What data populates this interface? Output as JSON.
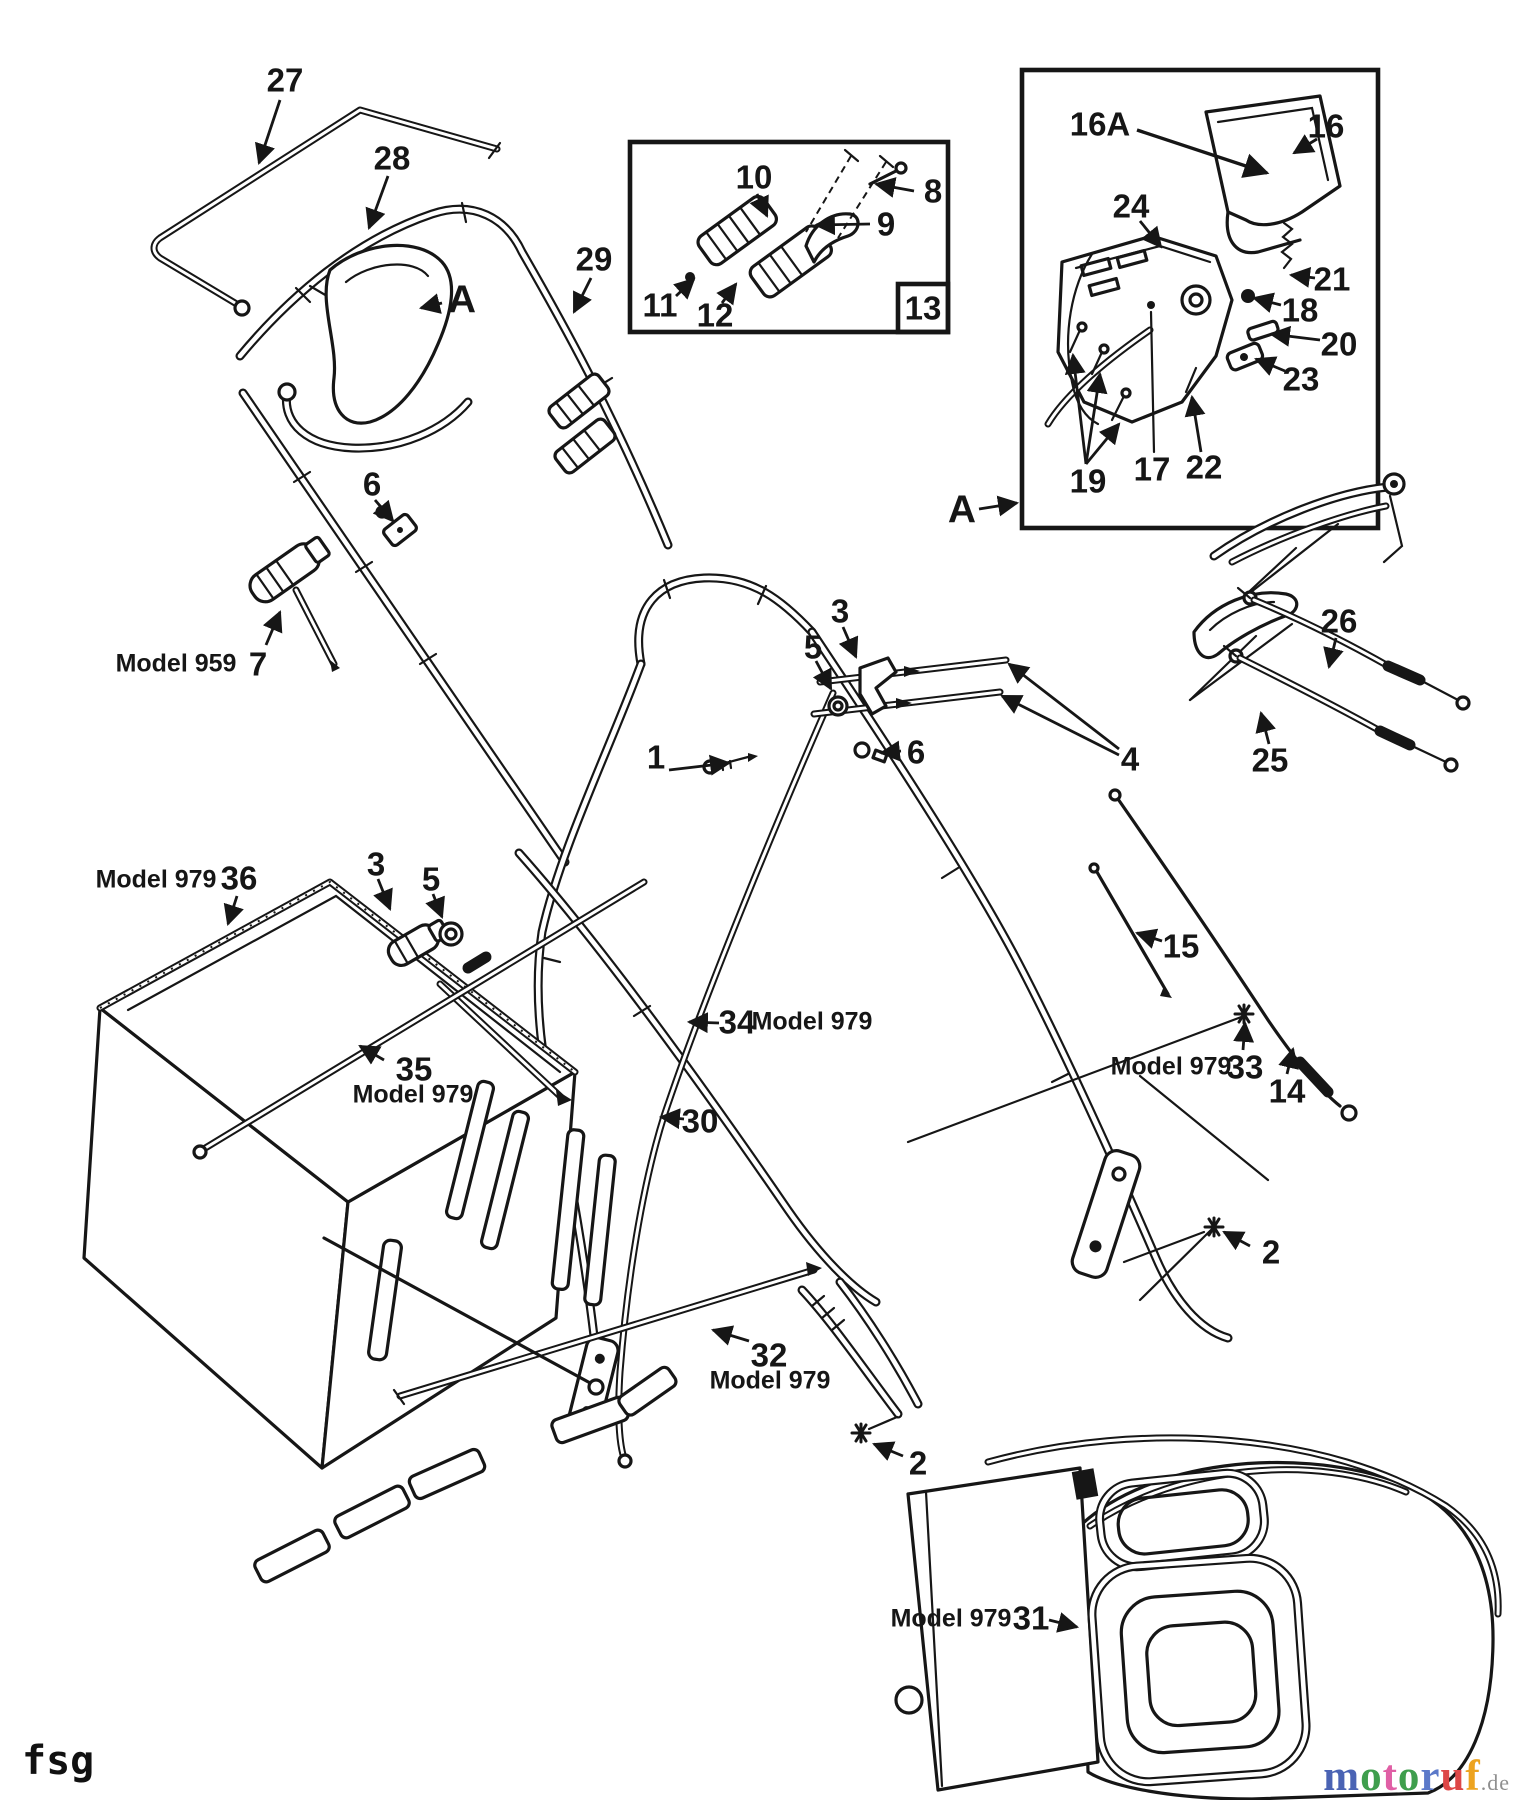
{
  "page": {
    "background": "#ffffff",
    "ink": "#161616"
  },
  "footer": {
    "left_text": "fsg",
    "logo": {
      "letters": [
        {
          "ch": "m",
          "color": "#4a63b4"
        },
        {
          "ch": "o",
          "color": "#3f9e4d"
        },
        {
          "ch": "t",
          "color": "#e05fa5"
        },
        {
          "ch": "o",
          "color": "#3f9e4d"
        },
        {
          "ch": "r",
          "color": "#5b79c9"
        },
        {
          "ch": "u",
          "color": "#dd4747"
        },
        {
          "ch": "f",
          "color": "#eda31f"
        }
      ],
      "suffix": ".de",
      "suffix_color": "#8f8f8f"
    }
  },
  "diagram": {
    "description": "Exploded parts diagram - mower handle, controls and grass catcher",
    "inset_boxes": [
      {
        "name": "detail-box-13",
        "corner_label": "13"
      },
      {
        "name": "detail-box-A",
        "reference_label": "A"
      }
    ],
    "labels": [
      {
        "name": "27",
        "text": "27",
        "kind": "num",
        "x": 285,
        "y": 80
      },
      {
        "name": "28",
        "text": "28",
        "kind": "num",
        "x": 392,
        "y": 158
      },
      {
        "name": "a-left",
        "text": "A",
        "kind": "letter",
        "x": 462,
        "y": 300
      },
      {
        "name": "29",
        "text": "29",
        "kind": "num",
        "x": 594,
        "y": 259
      },
      {
        "name": "10",
        "text": "10",
        "kind": "num",
        "x": 754,
        "y": 177
      },
      {
        "name": "8",
        "text": "8",
        "kind": "num",
        "x": 933,
        "y": 191
      },
      {
        "name": "9",
        "text": "9",
        "kind": "num",
        "x": 886,
        "y": 224
      },
      {
        "name": "11",
        "text": "11",
        "kind": "num",
        "x": 660,
        "y": 305
      },
      {
        "name": "12",
        "text": "12",
        "kind": "num",
        "x": 715,
        "y": 315
      },
      {
        "name": "13",
        "text": "13",
        "kind": "num",
        "x": 923,
        "y": 308
      },
      {
        "name": "16a",
        "text": "16A",
        "kind": "num",
        "x": 1100,
        "y": 124
      },
      {
        "name": "16",
        "text": "16",
        "kind": "num",
        "x": 1326,
        "y": 126
      },
      {
        "name": "24",
        "text": "24",
        "kind": "num",
        "x": 1131,
        "y": 206
      },
      {
        "name": "21",
        "text": "21",
        "kind": "num",
        "x": 1332,
        "y": 279
      },
      {
        "name": "18",
        "text": "18",
        "kind": "num",
        "x": 1300,
        "y": 310
      },
      {
        "name": "20",
        "text": "20",
        "kind": "num",
        "x": 1339,
        "y": 344
      },
      {
        "name": "23",
        "text": "23",
        "kind": "num",
        "x": 1301,
        "y": 379
      },
      {
        "name": "19",
        "text": "19",
        "kind": "num",
        "x": 1088,
        "y": 481
      },
      {
        "name": "17",
        "text": "17",
        "kind": "num",
        "x": 1152,
        "y": 469
      },
      {
        "name": "22",
        "text": "22",
        "kind": "num",
        "x": 1204,
        "y": 467
      },
      {
        "name": "a-right",
        "text": "A",
        "kind": "letter",
        "x": 962,
        "y": 510
      },
      {
        "name": "6-upper",
        "text": "6",
        "kind": "num",
        "x": 372,
        "y": 484
      },
      {
        "name": "model-959",
        "text": "Model 959",
        "kind": "note",
        "x": 176,
        "y": 664
      },
      {
        "name": "7",
        "text": "7",
        "kind": "num",
        "x": 258,
        "y": 664
      },
      {
        "name": "3-upper",
        "text": "3",
        "kind": "num",
        "x": 840,
        "y": 611
      },
      {
        "name": "5-upper",
        "text": "5",
        "kind": "num",
        "x": 813,
        "y": 647
      },
      {
        "name": "6-mid",
        "text": "6",
        "kind": "num",
        "x": 916,
        "y": 752
      },
      {
        "name": "1",
        "text": "1",
        "kind": "num",
        "x": 656,
        "y": 757
      },
      {
        "name": "4",
        "text": "4",
        "kind": "num",
        "x": 1130,
        "y": 759
      },
      {
        "name": "26",
        "text": "26",
        "kind": "num",
        "x": 1339,
        "y": 621
      },
      {
        "name": "25",
        "text": "25",
        "kind": "num",
        "x": 1270,
        "y": 760
      },
      {
        "name": "15",
        "text": "15",
        "kind": "num",
        "x": 1181,
        "y": 946
      },
      {
        "name": "model-979-36",
        "text": "Model 979",
        "kind": "note",
        "x": 156,
        "y": 880
      },
      {
        "name": "36",
        "text": "36",
        "kind": "num",
        "x": 239,
        "y": 878
      },
      {
        "name": "3-left",
        "text": "3",
        "kind": "num",
        "x": 376,
        "y": 864
      },
      {
        "name": "5-left",
        "text": "5",
        "kind": "num",
        "x": 431,
        "y": 879
      },
      {
        "name": "35",
        "text": "35",
        "kind": "num",
        "x": 414,
        "y": 1069
      },
      {
        "name": "model-979-35",
        "text": "Model 979",
        "kind": "note",
        "x": 413,
        "y": 1095
      },
      {
        "name": "34",
        "text": "34",
        "kind": "num",
        "x": 737,
        "y": 1022
      },
      {
        "name": "model-979-34",
        "text": "Model 979",
        "kind": "note",
        "x": 812,
        "y": 1022
      },
      {
        "name": "30",
        "text": "30",
        "kind": "num",
        "x": 700,
        "y": 1121
      },
      {
        "name": "model-979-33",
        "text": "Model 979",
        "kind": "note",
        "x": 1171,
        "y": 1067
      },
      {
        "name": "33",
        "text": "33",
        "kind": "num",
        "x": 1245,
        "y": 1067
      },
      {
        "name": "14",
        "text": "14",
        "kind": "num",
        "x": 1287,
        "y": 1091
      },
      {
        "name": "2-right",
        "text": "2",
        "kind": "num",
        "x": 1271,
        "y": 1252
      },
      {
        "name": "32",
        "text": "32",
        "kind": "num",
        "x": 769,
        "y": 1355
      },
      {
        "name": "model-979-32",
        "text": "Model 979",
        "kind": "note",
        "x": 770,
        "y": 1381
      },
      {
        "name": "2-bottom",
        "text": "2",
        "kind": "num",
        "x": 918,
        "y": 1463
      },
      {
        "name": "model-979-31",
        "text": "Model 979",
        "kind": "note",
        "x": 951,
        "y": 1619
      },
      {
        "name": "31",
        "text": "31",
        "kind": "num",
        "x": 1031,
        "y": 1618
      }
    ]
  }
}
